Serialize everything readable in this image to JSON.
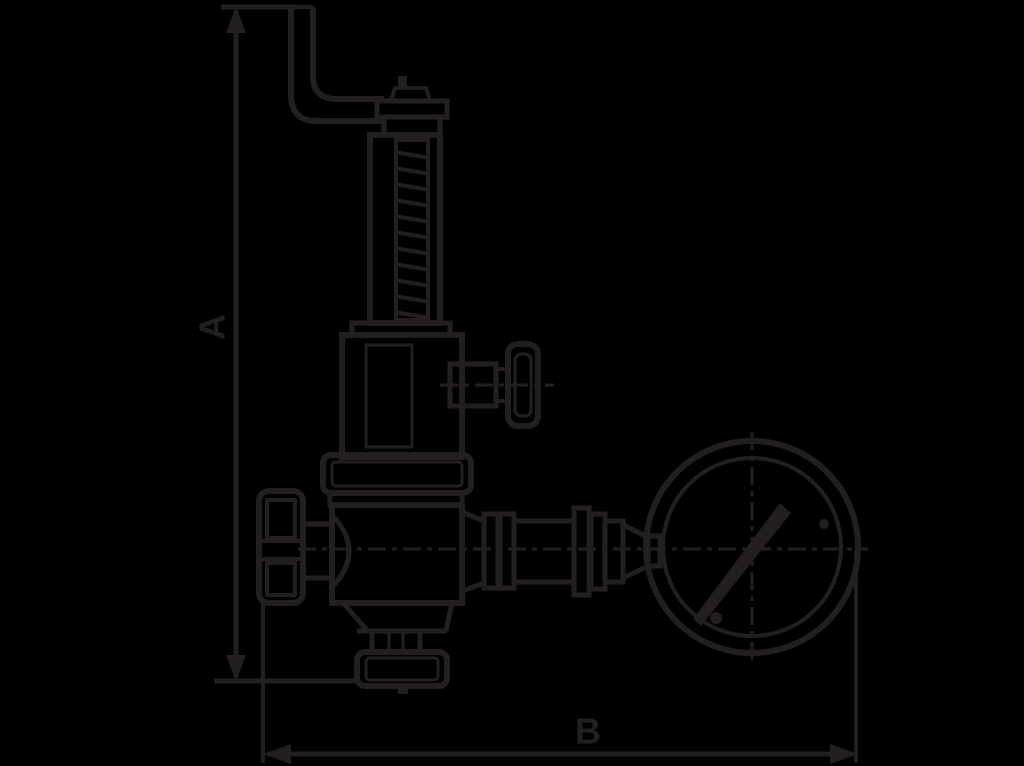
{
  "colors": {
    "background": "#000000",
    "line_ink": "#231f20"
  },
  "drawing": {
    "type": "technical-dimension-drawing",
    "subject": "safety relief valve with test lever and pressure gauge"
  },
  "dimensions": {
    "vertical": {
      "label": "A"
    },
    "horizontal": {
      "label": "B"
    }
  }
}
